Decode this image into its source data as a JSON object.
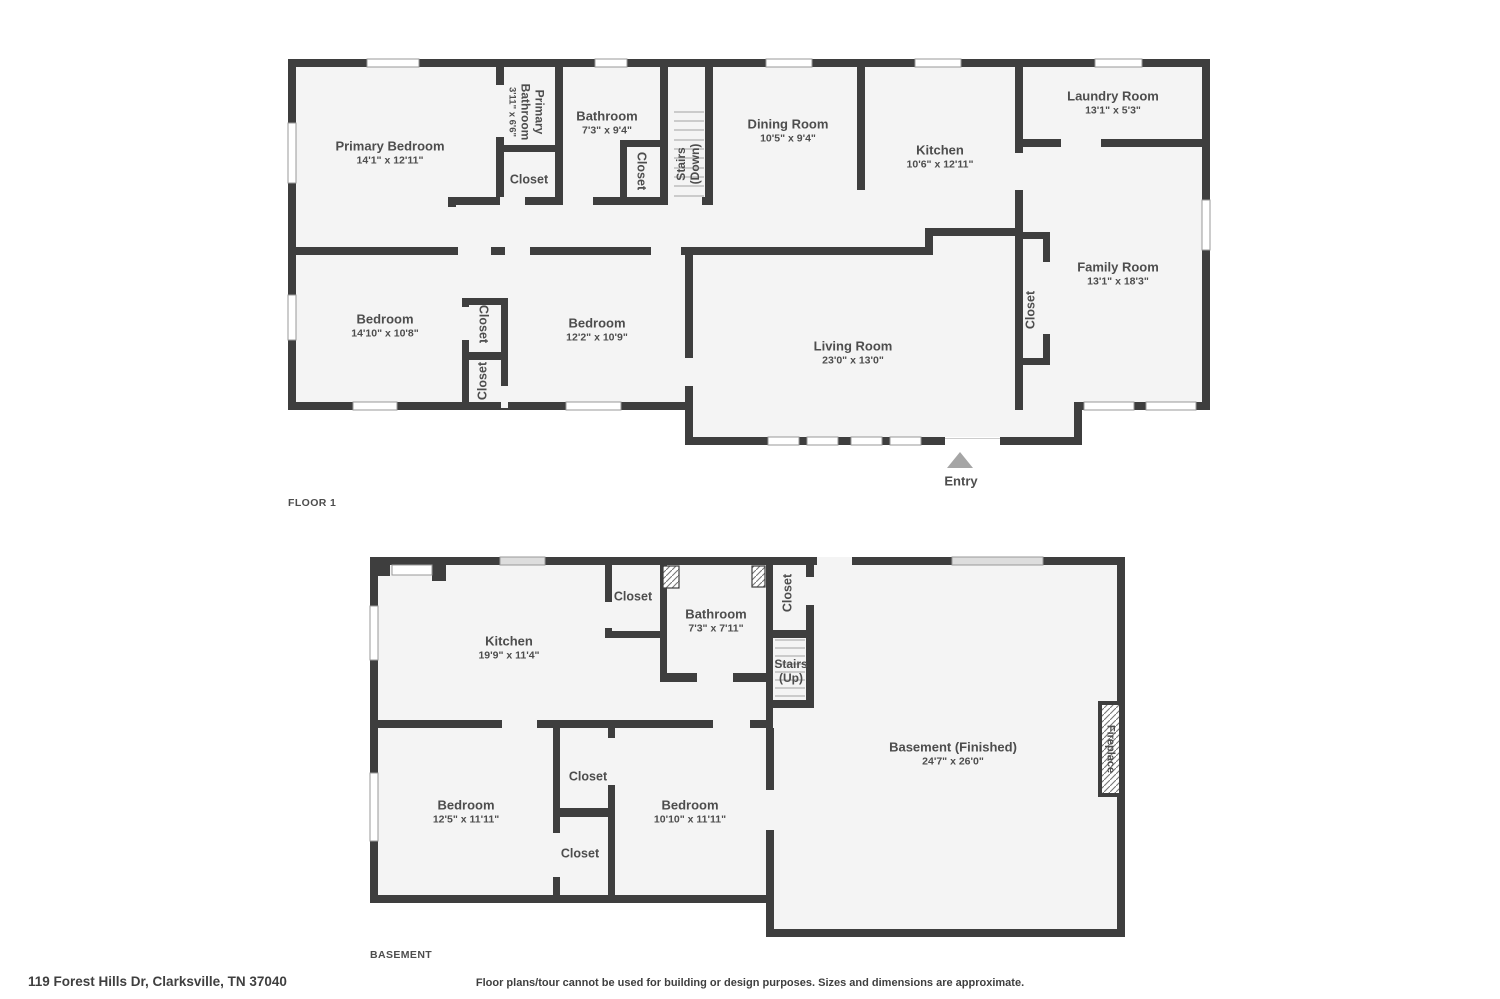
{
  "colors": {
    "wall": "#3e3e3e",
    "room_fill": "#f4f4f4",
    "text": "#4d4d4d",
    "entry_arrow": "#a5a5a5"
  },
  "floor1": {
    "floor_label": "FLOOR 1",
    "entry_label": "Entry",
    "rooms": [
      {
        "name": "Primary Bedroom",
        "dims": "14'1\" x 12'11\""
      },
      {
        "name": "Primary Bathroom",
        "dims": "3'11\" x 6'6\""
      },
      {
        "name": "Bathroom",
        "dims": "7'3\" x 9'4\""
      },
      {
        "name": "Closet"
      },
      {
        "name": "Closet"
      },
      {
        "name": "Stairs",
        "sub": "(Down)"
      },
      {
        "name": "Dining Room",
        "dims": "10'5\" x 9'4\""
      },
      {
        "name": "Kitchen",
        "dims": "10'6\" x 12'11\""
      },
      {
        "name": "Laundry Room",
        "dims": "13'1\" x 5'3\""
      },
      {
        "name": "Family Room",
        "dims": "13'1\" x 18'3\""
      },
      {
        "name": "Bedroom",
        "dims": "14'10\" x 10'8\""
      },
      {
        "name": "Closet"
      },
      {
        "name": "Closet"
      },
      {
        "name": "Bedroom",
        "dims": "12'2\" x 10'9\""
      },
      {
        "name": "Living Room",
        "dims": "23'0\" x 13'0\""
      },
      {
        "name": "Closet"
      }
    ]
  },
  "basement": {
    "floor_label": "BASEMENT",
    "rooms": [
      {
        "name": "Kitchen",
        "dims": "19'9\" x 11'4\""
      },
      {
        "name": "Closet"
      },
      {
        "name": "Bathroom",
        "dims": "7'3\" x 7'11\""
      },
      {
        "name": "Closet"
      },
      {
        "name": "Stairs",
        "sub": "(Up)"
      },
      {
        "name": "Basement (Finished)",
        "dims": "24'7\" x 26'0\""
      },
      {
        "name": "Fireplace"
      },
      {
        "name": "Bedroom",
        "dims": "12'5\" x 11'11\""
      },
      {
        "name": "Closet"
      },
      {
        "name": "Closet"
      },
      {
        "name": "Bedroom",
        "dims": "10'10\" x 11'11\""
      }
    ]
  },
  "footer": {
    "address": "119 Forest Hills Dr, Clarksville, TN 37040",
    "disclaimer": "Floor plans/tour cannot be used for building or design purposes. Sizes and dimensions are approximate."
  }
}
